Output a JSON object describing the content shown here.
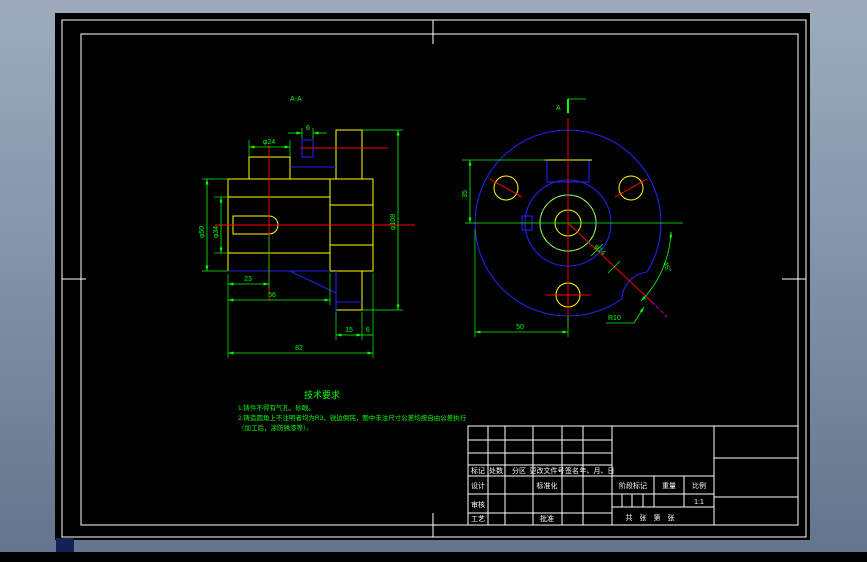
{
  "window": {
    "bg_top": "#9dabbd",
    "bg_bottom": "#64748c"
  },
  "colors": {
    "outline": "#ffff00",
    "hatch": "#00e8e8",
    "aux": "#2222ee",
    "center": "#ff0000",
    "dim": "#00ff00",
    "frame": "#ffffff",
    "phantom": "#cc00cc"
  },
  "section_view": {
    "title": "A-A",
    "dim_boss": "φ24",
    "dim_key": "6",
    "dim_hub": "φ50",
    "dim_bore": "φ34",
    "dim_od": "φ108",
    "dim_23": "23",
    "dim_56": "56",
    "dim_15": "15",
    "dim_6b": "6",
    "dim_82": "82"
  },
  "front_view": {
    "section_marker": "A",
    "dim_offset": "35",
    "dim_50": "50",
    "dim_angle": "45°",
    "dim_notch": "R10",
    "dim_hole": "φ14"
  },
  "tech_notes": {
    "title": "技术要求",
    "line1": "1.铸件不得有气孔、砂眼。",
    "line2": "2.铸造圆角上不注明者均为R3，锐边倒钝，图中未注尺寸公差均按自由公差执行",
    "line3": "（加工后，涂防锈漆等）。"
  },
  "title_block": {
    "h_mark": "标记",
    "h_count": "处数",
    "h_zone": "分区",
    "h_docno": "更改文件号",
    "h_sign": "签名",
    "h_date": "年、月、日",
    "design": "设计",
    "standard": "标准化",
    "review": "审核",
    "process": "工艺",
    "approve": "批准",
    "stage": "阶段标记",
    "weight": "重量",
    "scale": "比例",
    "scale_value": "1:1",
    "sheet": "共　张　第　张"
  }
}
